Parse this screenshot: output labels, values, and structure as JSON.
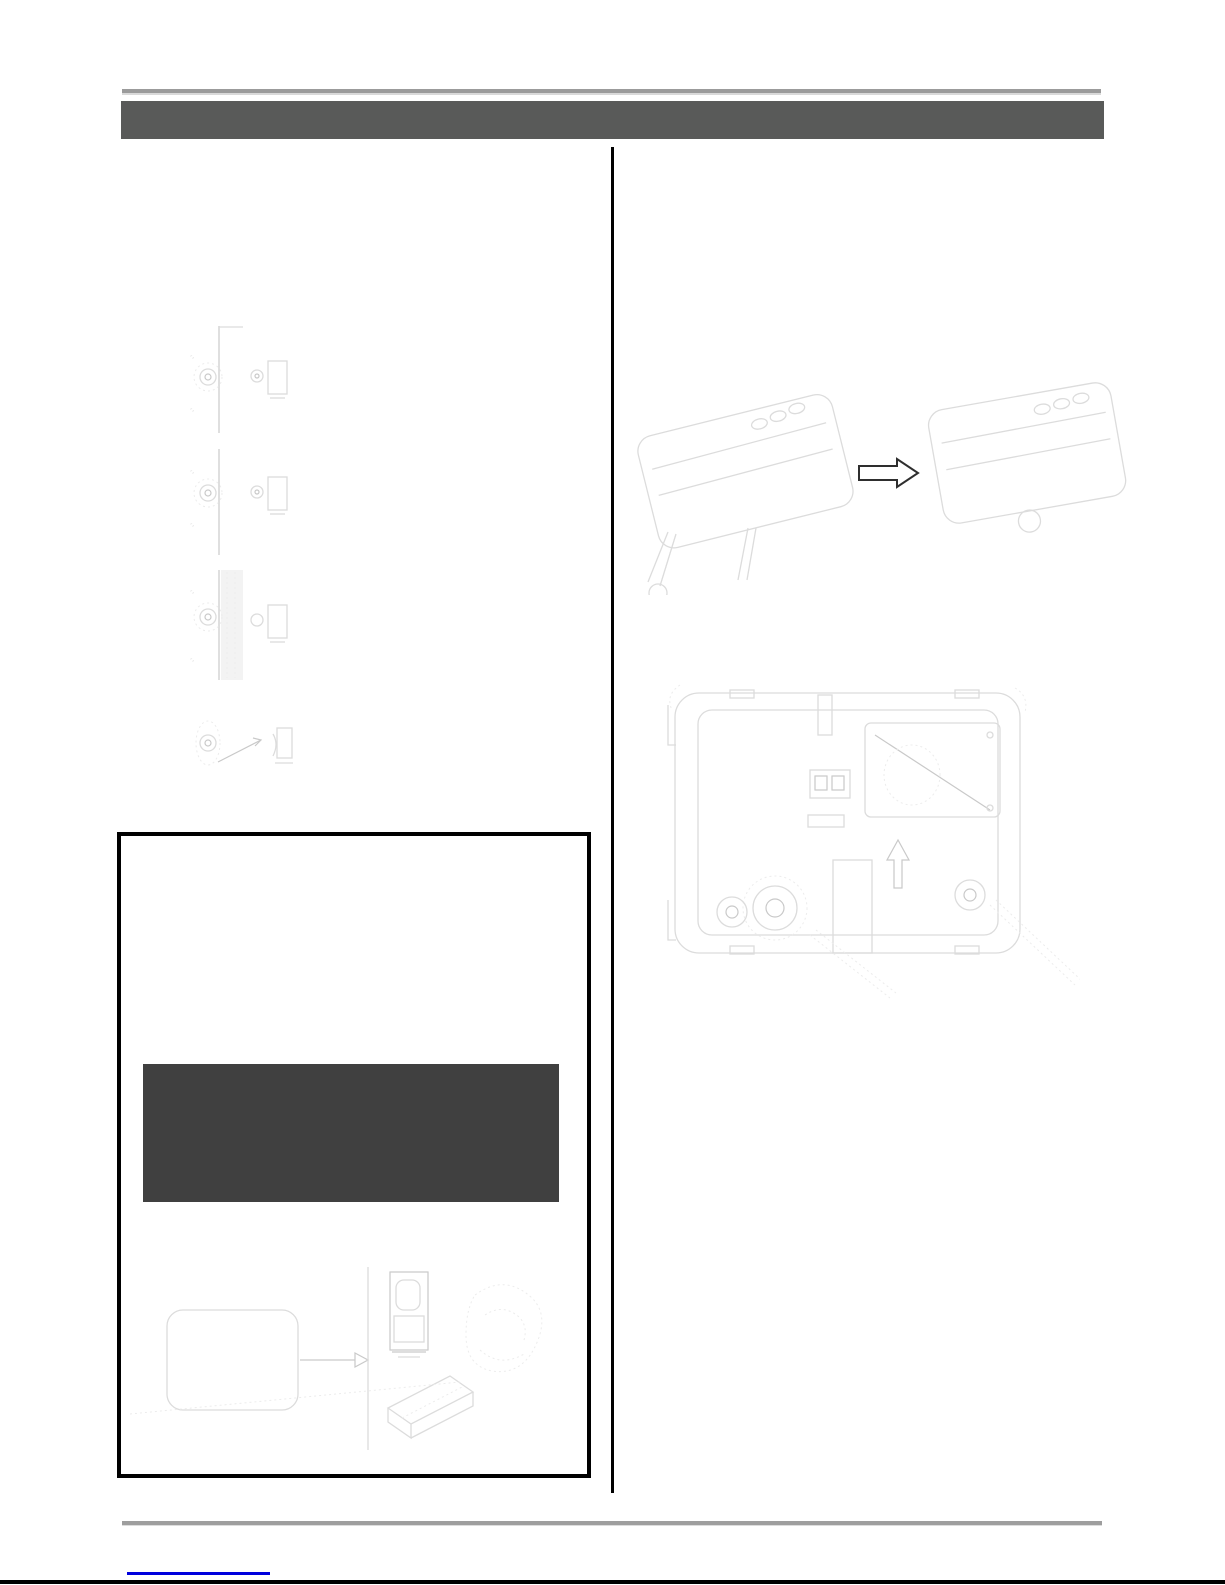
{
  "document": {
    "kind": "scanned-manual-page",
    "header": {
      "label": ""
    },
    "notice_box": {
      "panel_label": ""
    },
    "footer": {
      "link_text": ""
    }
  },
  "colors": {
    "page_bg": "#ffffff",
    "top_rule": "#9b9b9b",
    "top_rule_highlight": "#d9d9d9",
    "header_bar": "#595a59",
    "column_divider": "#000000",
    "notice_border": "#000000",
    "notice_panel": "#404040",
    "sketch_stroke": "#dcdcdc",
    "sketch_stroke_strong": "#c9c9c9",
    "arrow_stroke": "#2e2e2e",
    "bottom_rule": "#9e9e9e",
    "footer_link": "#0000dd",
    "page_edge": "#000000"
  },
  "left_column": {
    "steps": [
      {
        "name": "latch-mechanism-step-1"
      },
      {
        "name": "latch-mechanism-step-2"
      },
      {
        "name": "latch-mechanism-step-3"
      },
      {
        "name": "latch-mechanism-step-4"
      }
    ]
  },
  "right_column": {
    "figures": [
      {
        "name": "device-stand-removal-before-after",
        "arrow_direction": "right"
      },
      {
        "name": "device-bottom-view-screws",
        "arrow_direction": "up"
      }
    ]
  }
}
